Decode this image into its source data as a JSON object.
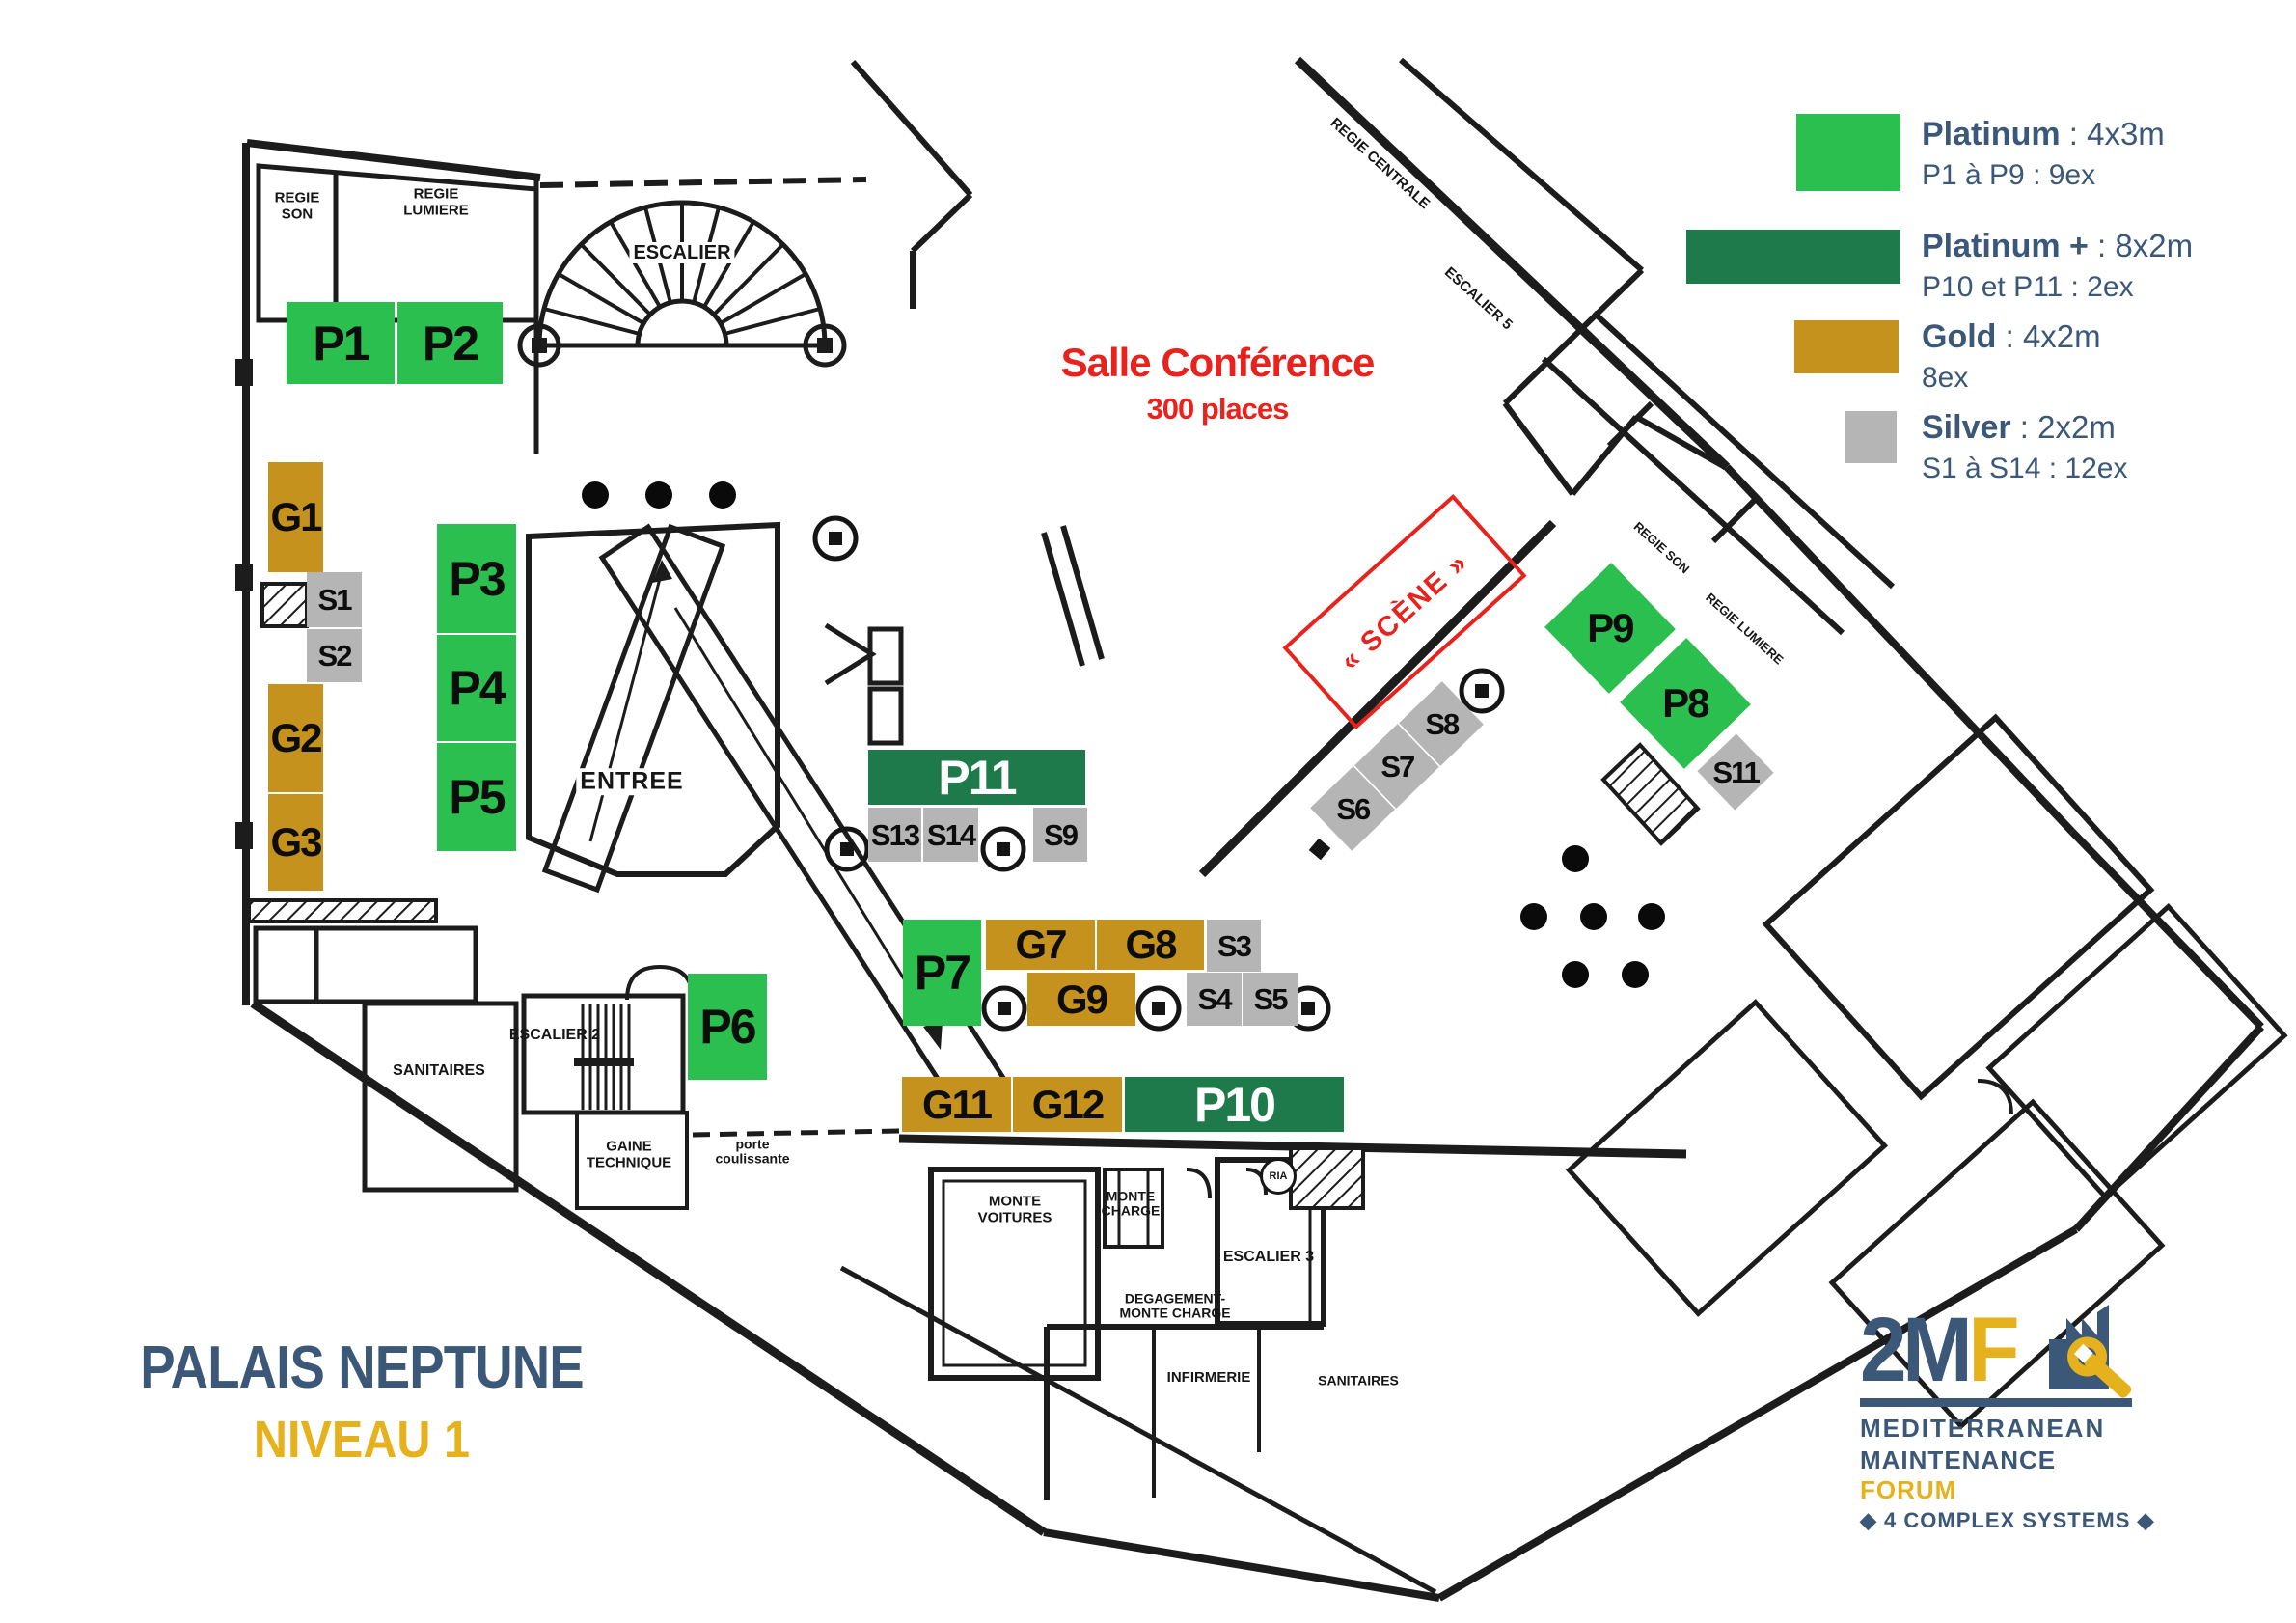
{
  "title": {
    "line1": "PALAIS NEPTUNE",
    "line2": "NIVEAU 1"
  },
  "colors": {
    "platinum": "#2abf4e",
    "platinum_plus": "#1f7a4b",
    "gold": "#c6921e",
    "silver": "#b5b5b5",
    "accent_blue": "#3b5878",
    "accent_gold": "#e5b21d",
    "red": "#e8231e"
  },
  "legend": {
    "items": [
      {
        "name": "Platinum",
        "spec": ": 4x3m",
        "detail": "P1 à P9 : 9ex",
        "tier": "platinum"
      },
      {
        "name": "Platinum +",
        "spec": ": 8x2m",
        "detail": "P10 et P11 : 2ex",
        "tier": "platinum_plus"
      },
      {
        "name": "Gold",
        "spec": ": 4x2m",
        "detail": "8ex",
        "tier": "gold"
      },
      {
        "name": "Silver",
        "spec": ": 2x2m",
        "detail": "S1 à S14 : 12ex",
        "tier": "silver"
      }
    ]
  },
  "conference": {
    "title": "Salle Conférence",
    "capacity": "300 places"
  },
  "stage": {
    "label": "« SCÈNE »"
  },
  "booths": {
    "P1": {
      "label": "P1",
      "tier": "Platinum"
    },
    "P2": {
      "label": "P2",
      "tier": "Platinum"
    },
    "P3": {
      "label": "P3",
      "tier": "Platinum"
    },
    "P4": {
      "label": "P4",
      "tier": "Platinum"
    },
    "P5": {
      "label": "P5",
      "tier": "Platinum"
    },
    "P6": {
      "label": "P6",
      "tier": "Platinum"
    },
    "P7": {
      "label": "P7",
      "tier": "Platinum"
    },
    "P8": {
      "label": "P8",
      "tier": "Platinum"
    },
    "P9": {
      "label": "P9",
      "tier": "Platinum"
    },
    "P10": {
      "label": "P10",
      "tier": "Platinum +"
    },
    "P11": {
      "label": "P11",
      "tier": "Platinum +"
    },
    "G1": {
      "label": "G1",
      "tier": "Gold"
    },
    "G2": {
      "label": "G2",
      "tier": "Gold"
    },
    "G3": {
      "label": "G3",
      "tier": "Gold"
    },
    "G7": {
      "label": "G7",
      "tier": "Gold"
    },
    "G8": {
      "label": "G8",
      "tier": "Gold"
    },
    "G9": {
      "label": "G9",
      "tier": "Gold"
    },
    "G11": {
      "label": "G11",
      "tier": "Gold"
    },
    "G12": {
      "label": "G12",
      "tier": "Gold"
    },
    "S1": {
      "label": "S1",
      "tier": "Silver"
    },
    "S2": {
      "label": "S2",
      "tier": "Silver"
    },
    "S3": {
      "label": "S3",
      "tier": "Silver"
    },
    "S4": {
      "label": "S4",
      "tier": "Silver"
    },
    "S5": {
      "label": "S5",
      "tier": "Silver"
    },
    "S6": {
      "label": "S6",
      "tier": "Silver"
    },
    "S7": {
      "label": "S7",
      "tier": "Silver"
    },
    "S8": {
      "label": "S8",
      "tier": "Silver"
    },
    "S9": {
      "label": "S9",
      "tier": "Silver"
    },
    "S11": {
      "label": "S11",
      "tier": "Silver"
    },
    "S13": {
      "label": "S13",
      "tier": "Silver"
    },
    "S14": {
      "label": "S14",
      "tier": "Silver"
    }
  },
  "map_labels": {
    "escalier": "ESCALIER",
    "escalier_2": "ESCALIER 2",
    "escalier_3": "ESCALIER 3",
    "escalier_5": "ESCALIER 5",
    "regie_son": "REGIE SON",
    "regie_lumiere": "REGIE LUMIERE",
    "regie_centrale": "REGIE CENTRALE",
    "sanitaires": "SANITAIRES",
    "gaine_technique": "GAINE TECHNIQUE",
    "porte_coulissante": "porte coulissante",
    "monte_voitures": "MONTE VOITURES",
    "monte_charge": "MONTE CHARGE",
    "degagement_monte_charge": "DEGAGEMENT- MONTE CHARGE",
    "infirmerie": "INFIRMERIE",
    "entree": "ENTREE",
    "ria": "RIA"
  },
  "logo": {
    "mark_blue": "2M",
    "mark_gold": "F",
    "line1": "MEDITERRANEAN",
    "line2_blue": "MAINTENANCE",
    "line2_gold": "FORUM",
    "line3": "◆ 4 COMPLEX SYSTEMS ◆"
  }
}
